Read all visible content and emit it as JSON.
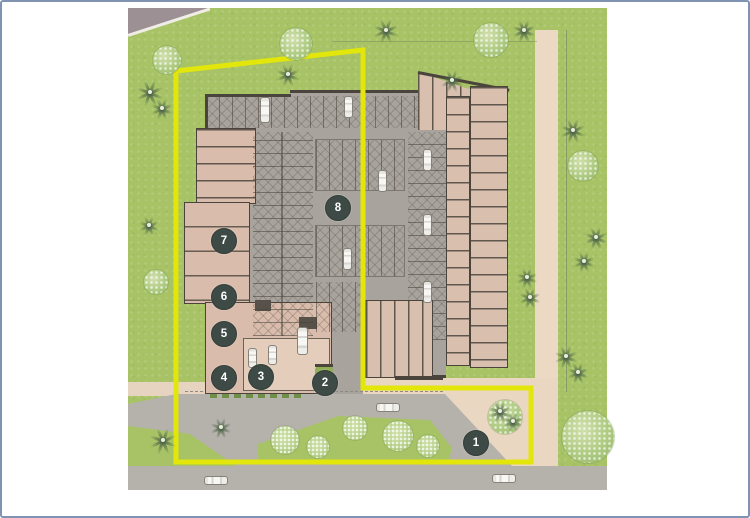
{
  "site_plan": {
    "markers": [
      {
        "label": "1",
        "x": 473,
        "y": 440
      },
      {
        "label": "2",
        "x": 322,
        "y": 380
      },
      {
        "label": "3",
        "x": 258,
        "y": 374
      },
      {
        "label": "4",
        "x": 221,
        "y": 375
      },
      {
        "label": "5",
        "x": 221,
        "y": 331
      },
      {
        "label": "6",
        "x": 221,
        "y": 294
      },
      {
        "label": "7",
        "x": 221,
        "y": 238
      },
      {
        "label": "8",
        "x": 335,
        "y": 205
      }
    ],
    "boundary": {
      "points": "174,69 361,48 361,386 529,386 529,460 174,460",
      "stroke": "#e2e60b",
      "width": 5
    },
    "colors": {
      "grass": "#a7c365",
      "garage_gray": "#a8a49d",
      "road_gray": "#b5b1ab",
      "building_tan": "#d9bcab",
      "path_tan": "#ecd9c4",
      "marker_bg": "#3e4a45",
      "marker_text": "#ffffff",
      "boundary_yellow": "#e2e60b",
      "frame_border": "#8093b3",
      "wall_dark": "#4a443c"
    },
    "trees": [
      {
        "t": "round",
        "x": 165,
        "y": 58,
        "r": 14
      },
      {
        "t": "round",
        "x": 294,
        "y": 42,
        "r": 16
      },
      {
        "t": "round",
        "x": 489,
        "y": 38,
        "r": 17
      },
      {
        "t": "round",
        "x": 581,
        "y": 164,
        "r": 15
      },
      {
        "t": "round",
        "x": 586,
        "y": 435,
        "r": 26
      },
      {
        "t": "round",
        "x": 154,
        "y": 280,
        "r": 12
      },
      {
        "t": "round",
        "x": 503,
        "y": 415,
        "r": 17
      },
      {
        "t": "bush",
        "x": 283,
        "y": 438,
        "r": 14
      },
      {
        "t": "bush",
        "x": 316,
        "y": 445,
        "r": 11
      },
      {
        "t": "bush",
        "x": 353,
        "y": 426,
        "r": 12
      },
      {
        "t": "bush",
        "x": 396,
        "y": 434,
        "r": 15
      },
      {
        "t": "bush",
        "x": 426,
        "y": 444,
        "r": 11
      },
      {
        "t": "palm",
        "x": 148,
        "y": 90,
        "r": 14
      },
      {
        "t": "palm",
        "x": 160,
        "y": 106,
        "r": 11
      },
      {
        "t": "palm",
        "x": 286,
        "y": 72,
        "r": 12
      },
      {
        "t": "palm",
        "x": 384,
        "y": 28,
        "r": 13
      },
      {
        "t": "palm",
        "x": 522,
        "y": 28,
        "r": 12
      },
      {
        "t": "palm",
        "x": 450,
        "y": 78,
        "r": 12
      },
      {
        "t": "palm",
        "x": 571,
        "y": 128,
        "r": 13
      },
      {
        "t": "palm",
        "x": 594,
        "y": 235,
        "r": 12
      },
      {
        "t": "palm",
        "x": 582,
        "y": 259,
        "r": 11
      },
      {
        "t": "palm",
        "x": 525,
        "y": 275,
        "r": 11
      },
      {
        "t": "palm",
        "x": 528,
        "y": 295,
        "r": 11
      },
      {
        "t": "palm",
        "x": 564,
        "y": 354,
        "r": 12
      },
      {
        "t": "palm",
        "x": 576,
        "y": 370,
        "r": 11
      },
      {
        "t": "palm",
        "x": 161,
        "y": 438,
        "r": 14
      },
      {
        "t": "palm",
        "x": 219,
        "y": 425,
        "r": 11
      },
      {
        "t": "palm",
        "x": 147,
        "y": 223,
        "r": 10
      },
      {
        "t": "palm",
        "x": 498,
        "y": 409,
        "r": 12
      },
      {
        "t": "palm",
        "x": 511,
        "y": 419,
        "r": 10
      }
    ],
    "cars": [
      {
        "x": 263,
        "y": 108,
        "o": "v",
        "l": 26,
        "w": 10
      },
      {
        "x": 346,
        "y": 105,
        "o": "v",
        "l": 22,
        "w": 9
      },
      {
        "x": 380,
        "y": 179,
        "o": "v",
        "l": 22,
        "w": 9
      },
      {
        "x": 345,
        "y": 257,
        "o": "v",
        "l": 22,
        "w": 9
      },
      {
        "x": 425,
        "y": 158,
        "o": "v",
        "l": 22,
        "w": 9
      },
      {
        "x": 425,
        "y": 223,
        "o": "v",
        "l": 22,
        "w": 9
      },
      {
        "x": 425,
        "y": 290,
        "o": "v",
        "l": 22,
        "w": 9
      },
      {
        "x": 300,
        "y": 339,
        "o": "v",
        "l": 28,
        "w": 11
      },
      {
        "x": 250,
        "y": 356,
        "o": "v",
        "l": 20,
        "w": 9
      },
      {
        "x": 270,
        "y": 353,
        "o": "v",
        "l": 20,
        "w": 9
      },
      {
        "x": 386,
        "y": 405,
        "o": "h",
        "l": 24,
        "w": 9
      },
      {
        "x": 214,
        "y": 478,
        "o": "h",
        "l": 24,
        "w": 9
      },
      {
        "x": 502,
        "y": 476,
        "o": "h",
        "l": 24,
        "w": 9
      }
    ]
  }
}
